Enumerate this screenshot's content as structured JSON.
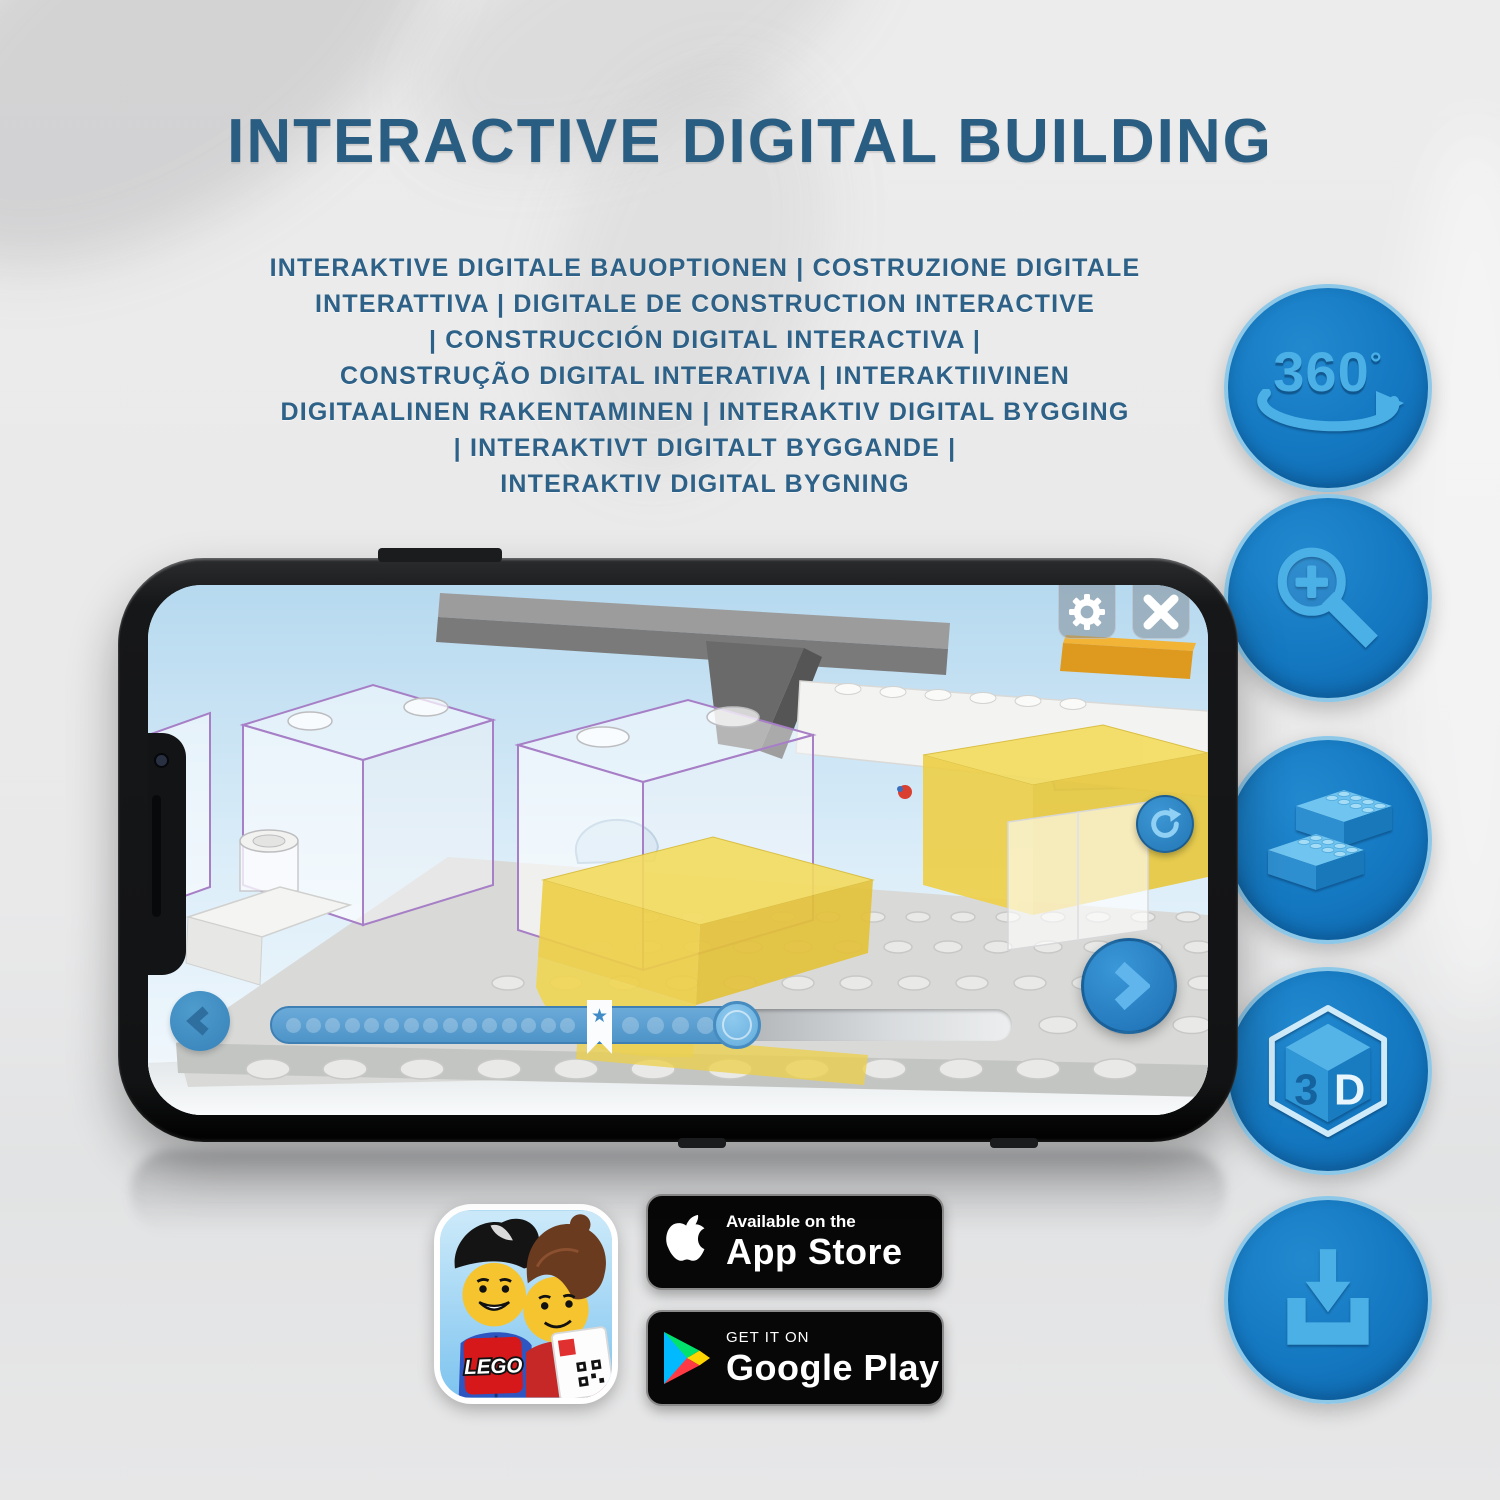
{
  "header": {
    "title": "INTERACTIVE DIGITAL BUILDING",
    "subtitle_lines": [
      "INTERAKTIVE DIGITALE BAUOPTIONEN | COSTRUZIONE DIGITALE",
      "INTERATTIVA | DIGITALE DE CONSTRUCTION INTERACTIVE",
      "| CONSTRUCCIÓN DIGITAL INTERACTIVA |",
      "CONSTRUÇÃO DIGITAL INTERATIVA | INTERAKTIIVINEN",
      "DIGITAALINEN RAKENTAMINEN | INTERAKTIV DIGITAL BYGGING",
      "| INTERAKTIVT DIGITALT BYGGANDE |",
      "INTERAKTIV DIGITAL BYGNING"
    ]
  },
  "feature_icons": {
    "rotate_360": {
      "label": "360",
      "degree_symbol": "°"
    },
    "cube_3d": {
      "left_face": "3",
      "right_face": "D"
    }
  },
  "phone_app": {
    "step_bar": {
      "bookmark_star": "★",
      "dots_before_bookmark": 15,
      "dots_after_bookmark": 5
    }
  },
  "store_badges": {
    "lego_app_icon": {
      "logo_text": "LEGO"
    },
    "app_store": {
      "line1": "Available on the",
      "line2": "App Store"
    },
    "google_play": {
      "line1": "GET IT ON",
      "line2": "Google Play"
    }
  },
  "colors": {
    "title_text": "#2a5d82",
    "icon_circle_fill": "#1478c1",
    "icon_circle_rim": "#8ec8e8",
    "icon_glyph": "#4bb0e6",
    "app_accent_blue": "#2e88c6",
    "brick_yellow": "#f0d44e",
    "ghost_outline_purple": "#a77fc6"
  }
}
